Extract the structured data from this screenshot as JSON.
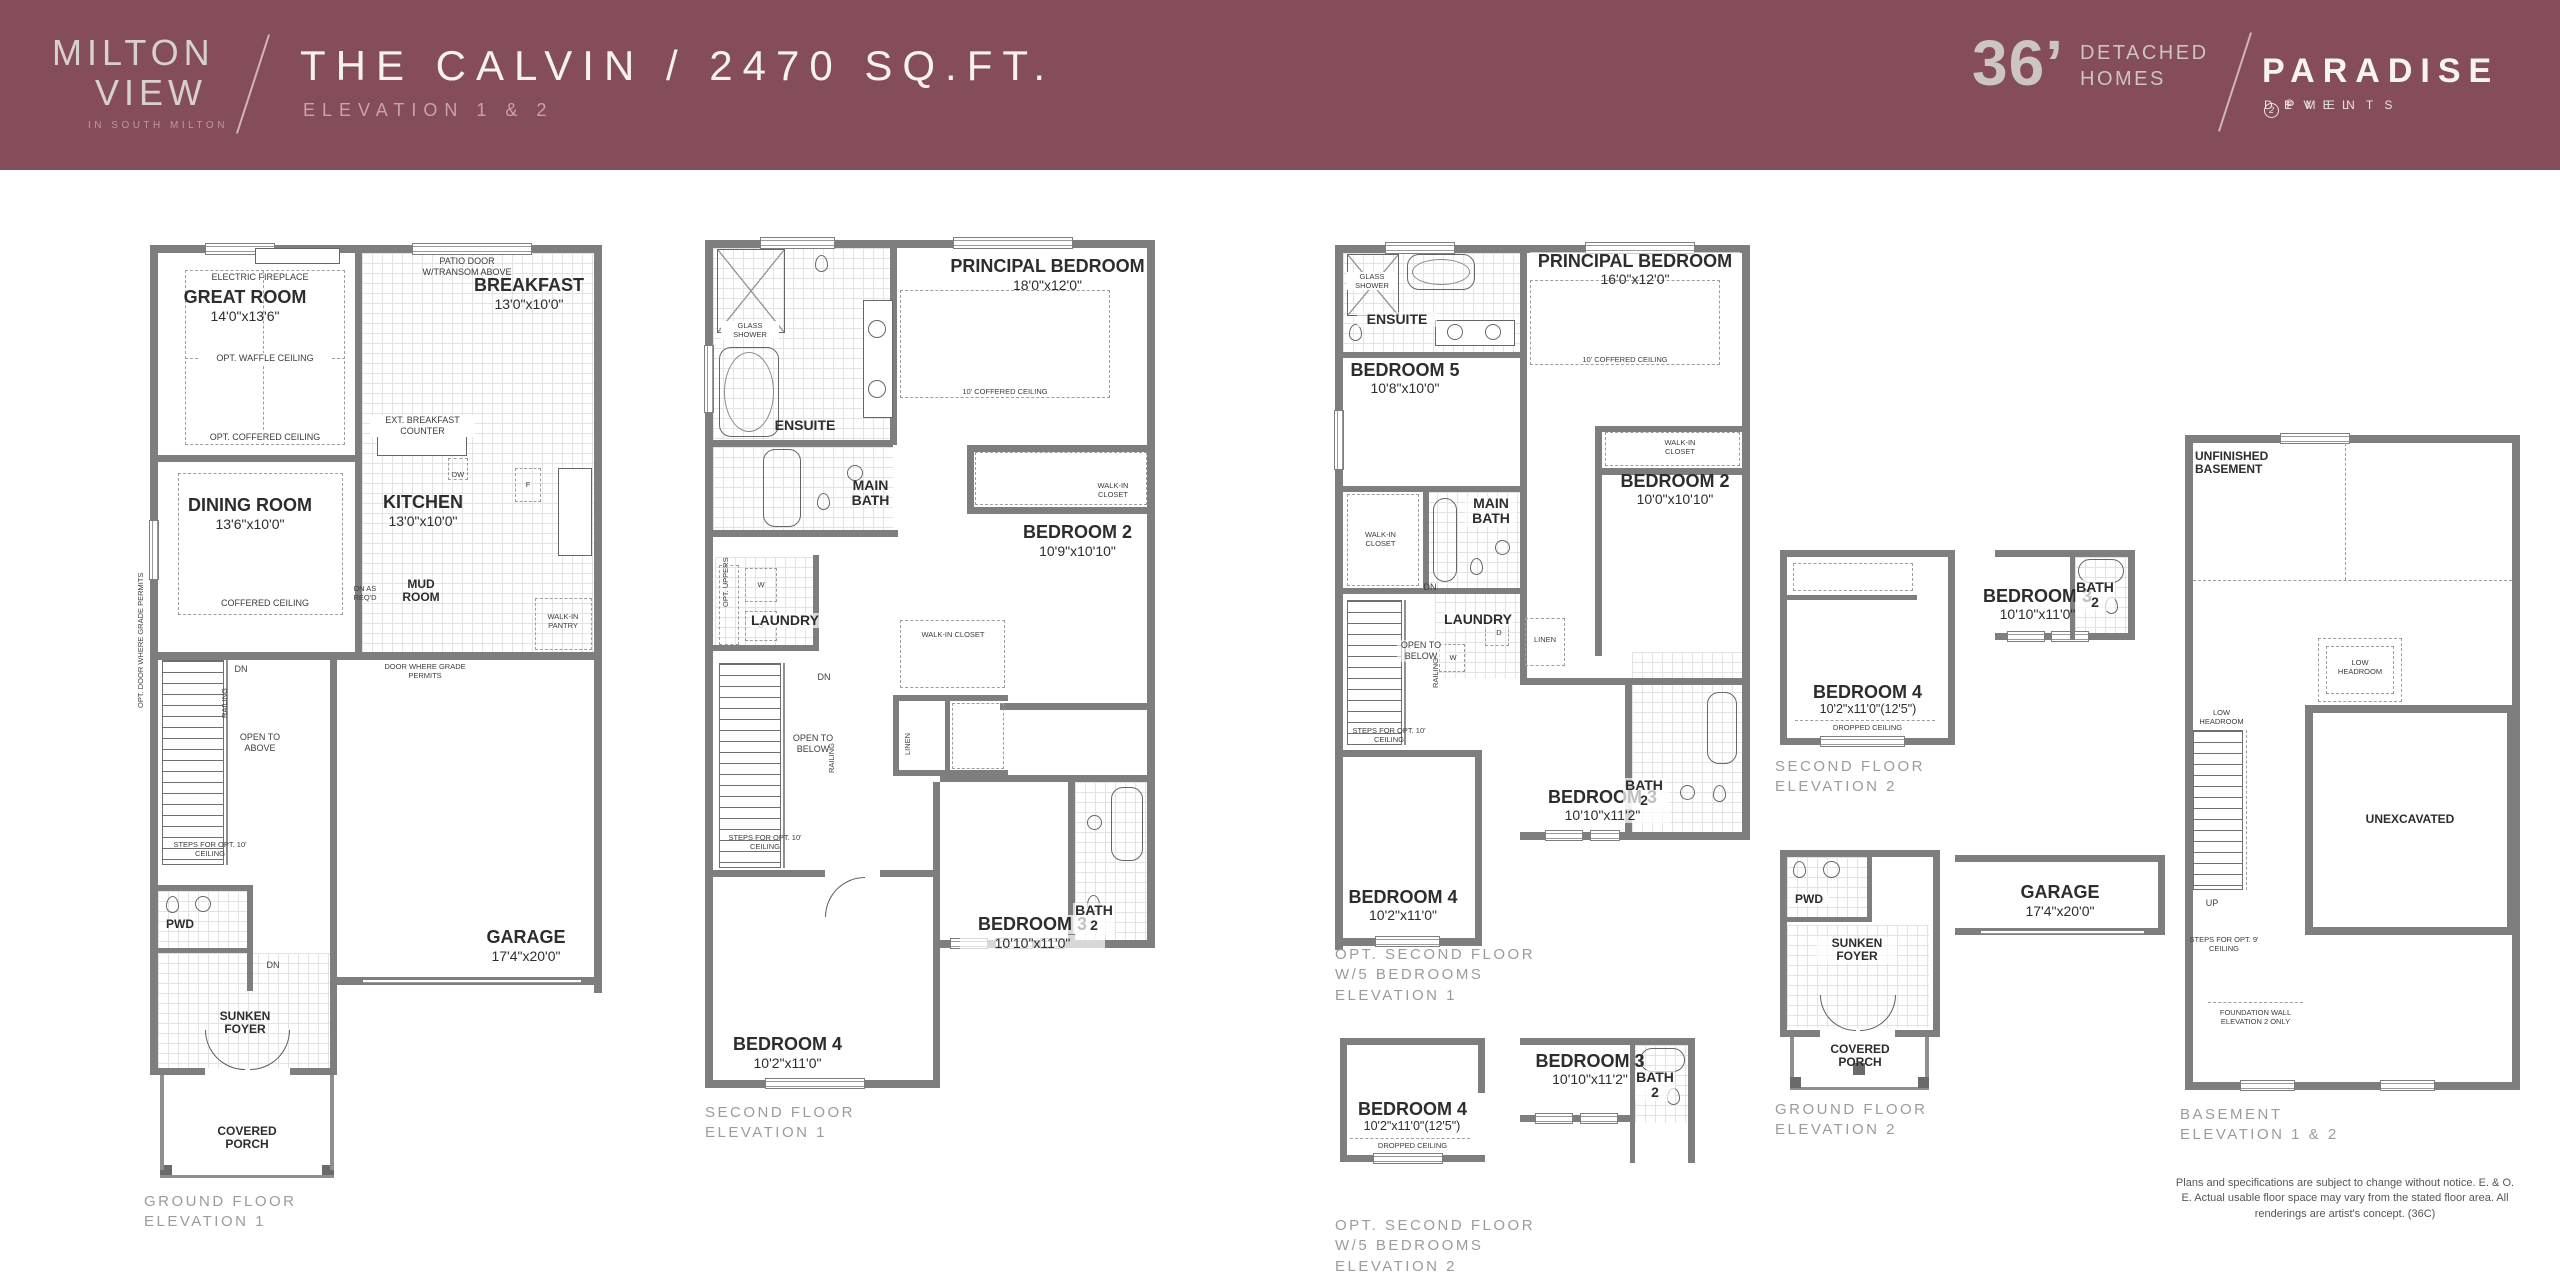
{
  "header": {
    "bg": "#854C59",
    "logo": {
      "line1": "MILTON",
      "line2": "VIEW",
      "tagline": "IN SOUTH MILTON"
    },
    "title": "THE CALVIN / 2470 SQ.FT.",
    "subtitle": "ELEVATION 1 & 2",
    "brand": {
      "size": "36’",
      "type_line1": "DETACHED",
      "type_line2": "HOMES",
      "name": "PARADISE",
      "dev_left": "D E V E L",
      "dev_mid": "2",
      "dev_right": "P M E N T S",
      "reg": "®"
    }
  },
  "disclaimer": "Plans and specifications are subject to change without notice. E. & O. E. Actual usable floor space may vary from the stated floor area. All renderings are artist's concept. (36C)",
  "plans": {
    "ground1": {
      "title1": "GROUND FLOOR",
      "title2": "ELEVATION 1",
      "rooms": {
        "great": {
          "name": "GREAT ROOM",
          "dims": "14'0\"x13'6\""
        },
        "breakfast": {
          "name": "BREAKFAST",
          "dims": "13'0\"x10'0\""
        },
        "dining": {
          "name": "DINING ROOM",
          "dims": "13'6\"x10'0\""
        },
        "kitchen": {
          "name": "KITCHEN",
          "dims": "13'0\"x10'0\""
        },
        "mud": {
          "name": "MUD ROOM"
        },
        "pwd": {
          "name": "PWD"
        },
        "foyer": {
          "name": "SUNKEN FOYER"
        },
        "garage": {
          "name": "GARAGE",
          "dims": "17'4\"x20'0\""
        },
        "porch": {
          "name": "COVERED PORCH"
        }
      },
      "notes": {
        "fireplace": "ELECTRIC FIREPLACE",
        "waffle": "OPT. WAFFLE CEILING",
        "opt_coffered": "OPT. COFFERED CEILING",
        "patio": "PATIO DOOR W/TRANSOM ABOVE",
        "ext_counter": "EXT. BREAKFAST COUNTER",
        "dw": "DW",
        "fridge": "F",
        "coffered": "COFFERED CEILING",
        "dn_req": "DN AS REQ'D",
        "pantry": "WALK-IN PANTRY",
        "door_grade": "DOOR WHERE GRADE PERMITS",
        "opt_door_grade": "OPT. DOOR WHERE GRADE PERMITS",
        "dn": "DN",
        "dn2": "DN",
        "open_above": "OPEN TO ABOVE",
        "railing": "RAILING",
        "steps": "STEPS FOR OPT. 10' CEILING"
      }
    },
    "second1": {
      "title1": "SECOND FLOOR",
      "title2": "ELEVATION 1",
      "rooms": {
        "principal": {
          "name": "PRINCIPAL BEDROOM",
          "dims": "18'0\"x12'0\""
        },
        "ensuite": {
          "name": "ENSUITE"
        },
        "mainbath": {
          "name": "MAIN BATH"
        },
        "bed2": {
          "name": "BEDROOM 2",
          "dims": "10'9\"x10'10\""
        },
        "laundry": {
          "name": "LAUNDRY"
        },
        "bed3": {
          "name": "BEDROOM 3",
          "dims": "10'10\"x11'0\""
        },
        "bath2": {
          "name": "BATH 2"
        },
        "bed4": {
          "name": "BEDROOM 4",
          "dims": "10'2\"x11'0\""
        }
      },
      "notes": {
        "glass": "GLASS SHOWER",
        "coffered": "10' COFFERED CEILING",
        "wic1": "WALK-IN CLOSET",
        "wic2": "WALK-IN CLOSET",
        "linen": "LINEN",
        "uppers": "OPT. UPPERS",
        "w": "W",
        "d": "D",
        "open_below": "OPEN TO BELOW",
        "railing": "RAILING",
        "dn": "DN",
        "steps": "STEPS FOR OPT. 10' CEILING"
      }
    },
    "opt5br1": {
      "title1": "OPT. SECOND FLOOR",
      "title2": "W/5 BEDROOMS",
      "title3": "ELEVATION 1",
      "rooms": {
        "principal": {
          "name": "PRINCIPAL BEDROOM",
          "dims": "16'0\"x12'0\""
        },
        "ensuite": {
          "name": "ENSUITE"
        },
        "bed5": {
          "name": "BEDROOM 5",
          "dims": "10'8\"x10'0\""
        },
        "mainbath": {
          "name": "MAIN BATH"
        },
        "bed2": {
          "name": "BEDROOM 2",
          "dims": "10'0\"x10'10\""
        },
        "laundry": {
          "name": "LAUNDRY"
        },
        "bed3": {
          "name": "BEDROOM 3",
          "dims": "10'10\"x11'2\""
        },
        "bath2": {
          "name": "BATH 2"
        },
        "bed4": {
          "name": "BEDROOM 4",
          "dims": "10'2\"x11'0\""
        }
      },
      "notes": {
        "glass": "GLASS SHOWER",
        "coffered": "10' COFFERED CEILING",
        "wic1": "WALK-IN CLOSET",
        "wic2": "WALK-IN CLOSET",
        "linen": "LINEN",
        "w": "W",
        "d": "D",
        "open_below": "OPEN TO BELOW",
        "railing": "RAILING",
        "dn": "DN",
        "steps": "STEPS FOR OPT. 10' CEILING"
      }
    },
    "opt5br2": {
      "title1": "OPT. SECOND FLOOR",
      "title2": "W/5 BEDROOMS",
      "title3": "ELEVATION 2",
      "rooms": {
        "bed4": {
          "name": "BEDROOM 4",
          "dims": "10'2\"x11'0\"(12'5\")"
        },
        "bed3": {
          "name": "BEDROOM 3",
          "dims": "10'10\"x11'2\""
        },
        "bath2": {
          "name": "BATH 2"
        }
      },
      "notes": {
        "dropped": "DROPPED CEILING"
      }
    },
    "second2": {
      "title1": "SECOND FLOOR",
      "title2": "ELEVATION 2",
      "rooms": {
        "bed4": {
          "name": "BEDROOM 4",
          "dims": "10'2\"x11'0\"(12'5\")"
        },
        "bed3": {
          "name": "BEDROOM 3",
          "dims": "10'10\"x11'0\""
        },
        "bath2": {
          "name": "BATH 2"
        }
      },
      "notes": {
        "dropped": "DROPPED CEILING"
      }
    },
    "ground2": {
      "title1": "GROUND FLOOR",
      "title2": "ELEVATION 2",
      "rooms": {
        "pwd": {
          "name": "PWD"
        },
        "foyer": {
          "name": "SUNKEN FOYER"
        },
        "garage": {
          "name": "GARAGE",
          "dims": "17'4\"x20'0\""
        },
        "porch": {
          "name": "COVERED PORCH"
        }
      }
    },
    "basement": {
      "title1": "BASEMENT",
      "title2": "ELEVATION 1 & 2",
      "rooms": {
        "unfinished": {
          "name": "UNFINISHED BASEMENT"
        },
        "unexcavated": {
          "name": "UNEXCAVATED"
        }
      },
      "notes": {
        "low1": "LOW HEADROOM",
        "low2": "LOW HEADROOM",
        "up": "UP",
        "steps": "STEPS FOR OPT. 9' CEILING",
        "foundation": "FOUNDATION WALL ELEVATION 2 ONLY"
      }
    }
  }
}
